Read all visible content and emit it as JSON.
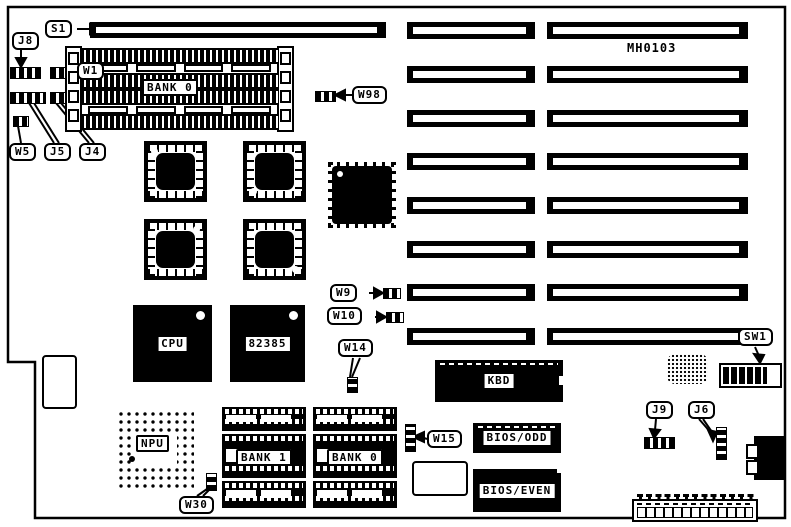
{
  "diagram": {
    "board_id": "MH0103",
    "colors": {
      "line": "#000000",
      "background": "#ffffff"
    },
    "callouts": {
      "s1": "S1",
      "j8": "J8",
      "w1": "W1",
      "w5": "W5",
      "j5": "J5",
      "j4": "J4",
      "w98": "W98",
      "w9": "W9",
      "w10": "W10",
      "w14": "W14",
      "w15": "W15",
      "w30": "W30",
      "j9": "J9",
      "j6": "J6",
      "sw1": "SW1"
    },
    "components": {
      "bank0_simm": "BANK 0",
      "cpu": "CPU",
      "cache_82385": "82385",
      "kbd": "KBD",
      "bios_odd": "BIOS/ODD",
      "bios_even": "BIOS/EVEN",
      "npu": "NPU",
      "bank1_dip": "BANK 1",
      "bank0_dip": "BANK 0"
    }
  }
}
